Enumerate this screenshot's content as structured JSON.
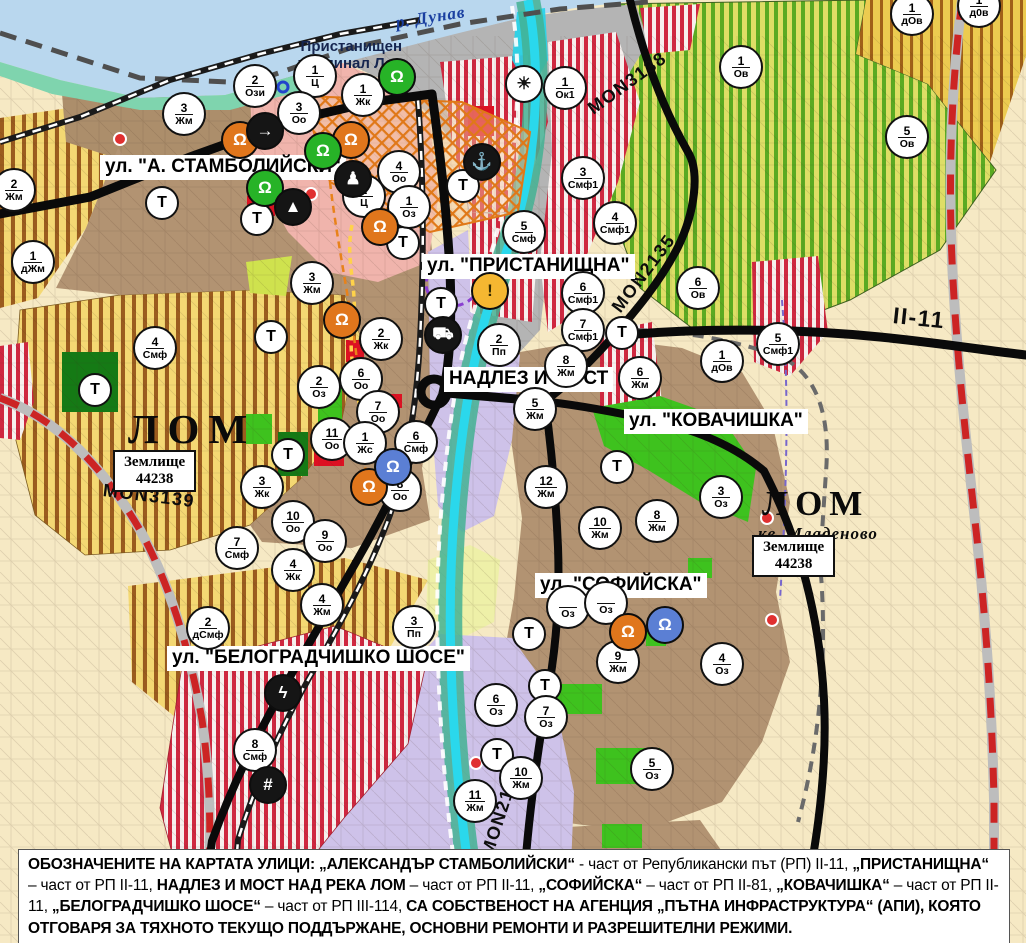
{
  "map": {
    "t_label": "Т",
    "labels": {
      "river": "р. Дунав",
      "port_terminal_lines": [
        "Пристанищен",
        "терминал Лом"
      ],
      "landplot_lines": [
        "Землище",
        "44238"
      ]
    },
    "street_labels": [
      {
        "text": "ул. \"А. СТАМБОЛИЙСКИ\"",
        "x": 100,
        "y": 155
      },
      {
        "text": "ул. \"ПРИСТАНИЩНА\"",
        "x": 422,
        "y": 254
      },
      {
        "text": "НАДЛЕЗ И МОСТ",
        "x": 444,
        "y": 367
      },
      {
        "text": "ул. \"КОВАЧИШКА\"",
        "x": 624,
        "y": 409
      },
      {
        "text": "ул. \"СОФИЙСКА\"",
        "x": 535,
        "y": 573
      },
      {
        "text": "ул. \"БЕЛОГРАДЧИШКО ШОСЕ\"",
        "x": 167,
        "y": 646
      }
    ],
    "road_labels": [
      {
        "text": "MON3138",
        "x": 590,
        "y": 100,
        "rot": -36,
        "size": 18
      },
      {
        "text": "MON2135",
        "x": 616,
        "y": 300,
        "rot": -53,
        "size": 18
      },
      {
        "text": "MON3139",
        "x": 103,
        "y": 480,
        "rot": 7,
        "size": 18
      },
      {
        "text": "MON2136",
        "x": 487,
        "y": 845,
        "rot": -72,
        "size": 18
      },
      {
        "text": "II-11",
        "x": 893,
        "y": 302,
        "rot": 6,
        "size": 23
      }
    ],
    "town_labels": [
      {
        "text": "ЛОМ",
        "x": 128,
        "y": 405,
        "size": 41,
        "spacing": 9,
        "italic": false
      },
      {
        "text": "ЛОМ",
        "x": 762,
        "y": 484,
        "size": 35,
        "spacing": 7,
        "italic": false
      },
      {
        "text": "кв. Младеново",
        "x": 758,
        "y": 524,
        "size": 17,
        "spacing": 1,
        "italic": true
      }
    ],
    "landplots": [
      {
        "x": 113,
        "y": 450
      },
      {
        "x": 752,
        "y": 535
      }
    ],
    "markers": [
      {
        "n": "2",
        "code": "Ози",
        "x": 255,
        "y": 86
      },
      {
        "n": "1",
        "code": "Ц",
        "x": 315,
        "y": 76
      },
      {
        "n": "1",
        "code": "Жк",
        "x": 363,
        "y": 95
      },
      {
        "n": "3",
        "code": "Жм",
        "x": 184,
        "y": 114
      },
      {
        "n": "3",
        "code": "Оо",
        "x": 299,
        "y": 113
      },
      {
        "n": "1",
        "code": "Ов",
        "x": 741,
        "y": 67
      },
      {
        "n": "1",
        "code": "дОв",
        "x": 912,
        "y": 14
      },
      {
        "n": "1",
        "code": "д0в",
        "x": 979,
        "y": 6
      },
      {
        "n": "5",
        "code": "Ов",
        "x": 907,
        "y": 137
      },
      {
        "n": "1",
        "code": "Ок1",
        "x": 565,
        "y": 88
      },
      {
        "n": "3",
        "code": "Смф1",
        "x": 583,
        "y": 178
      },
      {
        "n": "4",
        "code": "Смф1",
        "x": 615,
        "y": 223
      },
      {
        "n": "5",
        "code": "Смф",
        "x": 524,
        "y": 232
      },
      {
        "n": "6",
        "code": "Смф1",
        "x": 583,
        "y": 293
      },
      {
        "n": "7",
        "code": "Смф1",
        "x": 583,
        "y": 330
      },
      {
        "n": "6",
        "code": "Ов",
        "x": 698,
        "y": 288
      },
      {
        "n": "5",
        "code": "Смф1",
        "x": 778,
        "y": 344
      },
      {
        "n": "1",
        "code": "дОв",
        "x": 722,
        "y": 361
      },
      {
        "n": "2",
        "code": "Жм",
        "x": 14,
        "y": 190
      },
      {
        "n": "1",
        "code": "дЖм",
        "x": 33,
        "y": 262
      },
      {
        "n": "4",
        "code": "Смф",
        "x": 155,
        "y": 348
      },
      {
        "n": "3",
        "code": "Жм",
        "x": 312,
        "y": 283
      },
      {
        "n": "2",
        "code": "Жк",
        "x": 381,
        "y": 339
      },
      {
        "n": "2",
        "code": "Оз",
        "x": 319,
        "y": 387
      },
      {
        "n": "6",
        "code": "Оо",
        "x": 361,
        "y": 379
      },
      {
        "n": "7",
        "code": "Оо",
        "x": 378,
        "y": 412
      },
      {
        "n": "11",
        "code": "Оо",
        "x": 332,
        "y": 439
      },
      {
        "n": "1",
        "code": "Жс",
        "x": 365,
        "y": 443
      },
      {
        "n": "6",
        "code": "Смф",
        "x": 416,
        "y": 442
      },
      {
        "n": "8",
        "code": "Оо",
        "x": 400,
        "y": 490
      },
      {
        "n": "4",
        "code": "Оо",
        "x": 399,
        "y": 172
      },
      {
        "n": "2",
        "code": "Ц",
        "x": 364,
        "y": 196
      },
      {
        "n": "1",
        "code": "Оз",
        "x": 409,
        "y": 207
      },
      {
        "n": "2",
        "code": "Пп",
        "x": 499,
        "y": 345
      },
      {
        "n": "3",
        "code": "Пп",
        "x": 414,
        "y": 627
      },
      {
        "n": "8",
        "code": "Жм",
        "x": 566,
        "y": 366
      },
      {
        "n": "5",
        "code": "Жм",
        "x": 535,
        "y": 409
      },
      {
        "n": "6",
        "code": "Жм",
        "x": 640,
        "y": 378
      },
      {
        "n": "12",
        "code": "Жм",
        "x": 546,
        "y": 487
      },
      {
        "n": "8",
        "code": "Жм",
        "x": 657,
        "y": 521
      },
      {
        "n": "10",
        "code": "Жм",
        "x": 600,
        "y": 528
      },
      {
        "n": "3",
        "code": "Оз",
        "x": 721,
        "y": 497
      },
      {
        "n": "3",
        "code": "Жк",
        "x": 262,
        "y": 487
      },
      {
        "n": "10",
        "code": "Оо",
        "x": 293,
        "y": 522
      },
      {
        "n": "9",
        "code": "Оо",
        "x": 325,
        "y": 541
      },
      {
        "n": "7",
        "code": "Смф",
        "x": 237,
        "y": 548
      },
      {
        "n": "4",
        "code": "Жк",
        "x": 293,
        "y": 570
      },
      {
        "n": "4",
        "code": "Жм",
        "x": 322,
        "y": 605
      },
      {
        "n": "2",
        "code": "дСмф",
        "x": 208,
        "y": 628
      },
      {
        "n": "",
        "code": "Оз",
        "x": 568,
        "y": 607
      },
      {
        "n": "",
        "code": "Оз",
        "x": 606,
        "y": 603
      },
      {
        "n": "9",
        "code": "Жм",
        "x": 618,
        "y": 662
      },
      {
        "n": "4",
        "code": "Оз",
        "x": 722,
        "y": 664
      },
      {
        "n": "6",
        "code": "Оз",
        "x": 496,
        "y": 705
      },
      {
        "n": "7",
        "code": "Оз",
        "x": 546,
        "y": 717
      },
      {
        "n": "5",
        "code": "Оз",
        "x": 652,
        "y": 769
      },
      {
        "n": "10",
        "code": "Жм",
        "x": 521,
        "y": 778
      },
      {
        "n": "11",
        "code": "Жм",
        "x": 475,
        "y": 801
      },
      {
        "n": "8",
        "code": "Смф",
        "x": 255,
        "y": 750
      }
    ],
    "t_markers": [
      {
        "x": 95,
        "y": 390
      },
      {
        "x": 162,
        "y": 203
      },
      {
        "x": 257,
        "y": 219
      },
      {
        "x": 271,
        "y": 337
      },
      {
        "x": 288,
        "y": 455
      },
      {
        "x": 441,
        "y": 304
      },
      {
        "x": 463,
        "y": 186
      },
      {
        "x": 403,
        "y": 243
      },
      {
        "x": 622,
        "y": 333
      },
      {
        "x": 617,
        "y": 467
      },
      {
        "x": 529,
        "y": 634
      },
      {
        "x": 545,
        "y": 686
      },
      {
        "x": 497,
        "y": 755
      }
    ],
    "icon_markers": [
      {
        "name": "monument-icon",
        "glyph": "Ω",
        "bg": "#e0761c",
        "fg": "#fff",
        "x": 240,
        "y": 140
      },
      {
        "name": "one-way-arrow-icon",
        "glyph": "→",
        "bg": "#151515",
        "fg": "#fff",
        "x": 265,
        "y": 131
      },
      {
        "name": "monument-icon",
        "glyph": "Ω",
        "bg": "#e0761c",
        "fg": "#fff",
        "x": 351,
        "y": 140
      },
      {
        "name": "monument-green-icon",
        "glyph": "Ω",
        "bg": "#27b327",
        "fg": "#fff",
        "x": 323,
        "y": 151
      },
      {
        "name": "monument-green-icon",
        "glyph": "Ω",
        "bg": "#27b327",
        "fg": "#fff",
        "x": 265,
        "y": 188
      },
      {
        "name": "person-icon",
        "glyph": "♟",
        "bg": "#151515",
        "fg": "#fff",
        "x": 353,
        "y": 179
      },
      {
        "name": "mound-icon",
        "glyph": "▲",
        "bg": "#151515",
        "fg": "#fff",
        "x": 293,
        "y": 207
      },
      {
        "name": "monument-icon",
        "glyph": "Ω",
        "bg": "#e0761c",
        "fg": "#fff",
        "x": 380,
        "y": 227
      },
      {
        "name": "monument-icon",
        "glyph": "Ω",
        "bg": "#e0761c",
        "fg": "#fff",
        "x": 342,
        "y": 320
      },
      {
        "name": "monument-icon",
        "glyph": "Ω",
        "bg": "#e0761c",
        "fg": "#fff",
        "x": 369,
        "y": 487
      },
      {
        "name": "culture-blue-icon",
        "glyph": "Ω",
        "bg": "#5b7fd4",
        "fg": "#fff",
        "x": 393,
        "y": 467
      },
      {
        "name": "monument-icon",
        "glyph": "Ω",
        "bg": "#e0761c",
        "fg": "#fff",
        "x": 628,
        "y": 632
      },
      {
        "name": "culture-blue-icon",
        "glyph": "Ω",
        "bg": "#5b7fd4",
        "fg": "#fff",
        "x": 665,
        "y": 625
      },
      {
        "name": "terminal-green-icon",
        "glyph": "Ω",
        "bg": "#27b327",
        "fg": "#fff",
        "x": 397,
        "y": 77
      },
      {
        "name": "fan-icon",
        "glyph": "☀",
        "bg": "#ffffff",
        "fg": "#111",
        "x": 524,
        "y": 84
      },
      {
        "name": "anchor-icon",
        "glyph": "⚓",
        "bg": "#151515",
        "fg": "#fff",
        "x": 482,
        "y": 162
      },
      {
        "name": "truck-icon",
        "glyph": "⛟",
        "bg": "#151515",
        "fg": "#fff",
        "x": 443,
        "y": 335
      },
      {
        "name": "warning-icon",
        "glyph": "!",
        "bg": "#f5b731",
        "fg": "#3a2c00",
        "x": 490,
        "y": 291
      },
      {
        "name": "lightning-icon",
        "glyph": "ϟ",
        "bg": "#151515",
        "fg": "#fff",
        "x": 283,
        "y": 693
      },
      {
        "name": "railway-crossing-icon",
        "glyph": "#",
        "bg": "#151515",
        "fg": "#fff",
        "x": 268,
        "y": 785
      }
    ],
    "colors": {
      "residential_brown": "#b29372",
      "striped_yellow_zone": "#f4d873",
      "vineyard_zone": "#dede66",
      "smf_red_stripe": "#cf2840",
      "production_purple": "#cec2e9",
      "park_green": "#3ec21e",
      "port_gray": "#b4b4b4",
      "danube_blue": "#b9d7ee",
      "lom_river_cyan": "#2ad8ec",
      "center_pink": "#f0b4ac",
      "marker_accent_orange": "#e0761c"
    }
  },
  "footer": {
    "segments": [
      {
        "t": "ОБОЗНАЧЕНИТЕ НА КАРТАТА УЛИЦИ: „АЛЕКСАНДЪР СТАМБОЛИЙСКИ“",
        "b": true
      },
      {
        "t": " - част от Републикански път (РП) II-11, ",
        "b": false
      },
      {
        "t": "„ПРИСТАНИЩНА“",
        "b": true
      },
      {
        "t": " – част от РП II-11, ",
        "b": false
      },
      {
        "t": "НАДЛЕЗ И МОСТ НАД РЕКА ЛОМ",
        "b": true
      },
      {
        "t": " – част от РП II-11, ",
        "b": false
      },
      {
        "t": "„СОФИЙСКА“",
        "b": true
      },
      {
        "t": " – част от РП II-81, ",
        "b": false
      },
      {
        "t": "„КОВАЧИШКА“",
        "b": true
      },
      {
        "t": " – част от РП II-11, ",
        "b": false
      },
      {
        "t": "„БЕЛОГРАДЧИШКО ШОСЕ“",
        "b": true
      },
      {
        "t": " – част от РП III-114, ",
        "b": false
      },
      {
        "t": "СА СОБСТВЕНОСТ НА АГЕНЦИЯ „ПЪТНА ИНФРАСТРУКТУРА“ (АПИ), КОЯТО ОТГОВАРЯ ЗА ТЯХНОТО ТЕКУЩО ПОДДЪРЖАНЕ, ОСНОВНИ РЕМОНТИ И РАЗРЕШИТЕЛНИ РЕЖИМИ.",
        "b": true
      }
    ]
  }
}
